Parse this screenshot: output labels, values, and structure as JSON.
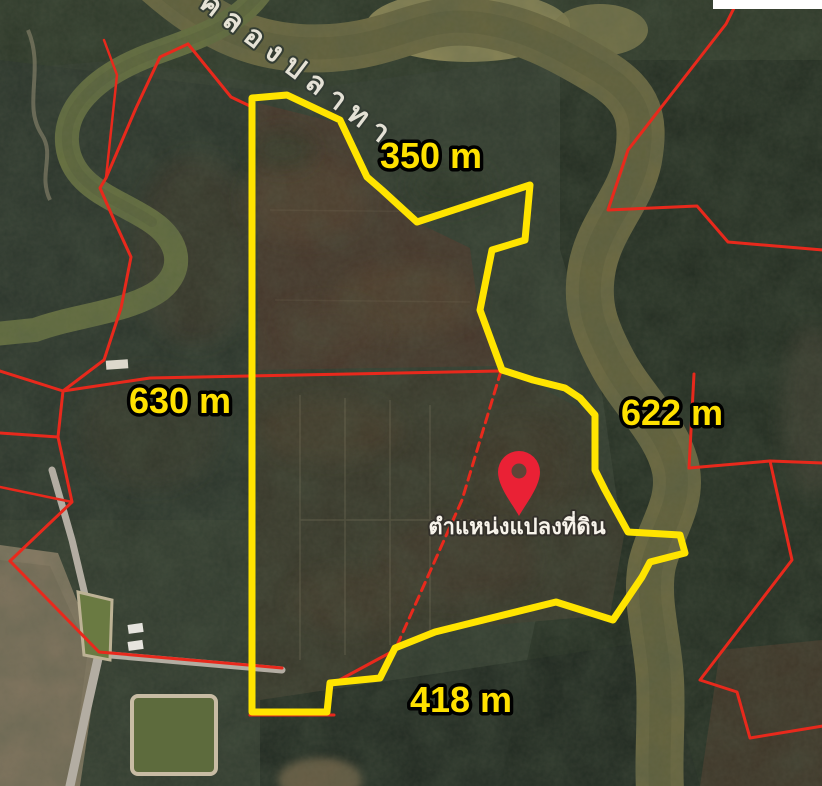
{
  "map": {
    "view_type": "satellite",
    "river_name": "คลองปลาทาง",
    "pin": {
      "caption": "ตำแหน่งแปลงที่ดิน"
    },
    "measurements": {
      "north": "350 m",
      "west": "630 m",
      "east": "622 m",
      "south": "418 m"
    },
    "parcel": {
      "side_lengths_m": {
        "north": 350,
        "west": 630,
        "east": 622,
        "south": 418
      }
    },
    "colors": {
      "parcel_outline": "#ffe400",
      "boundary_lines": "#e8291c",
      "pin": "#ea2135",
      "measurement_text": "#ffe100",
      "measurement_outline": "#000000",
      "river_water": "#6e6a41"
    }
  }
}
